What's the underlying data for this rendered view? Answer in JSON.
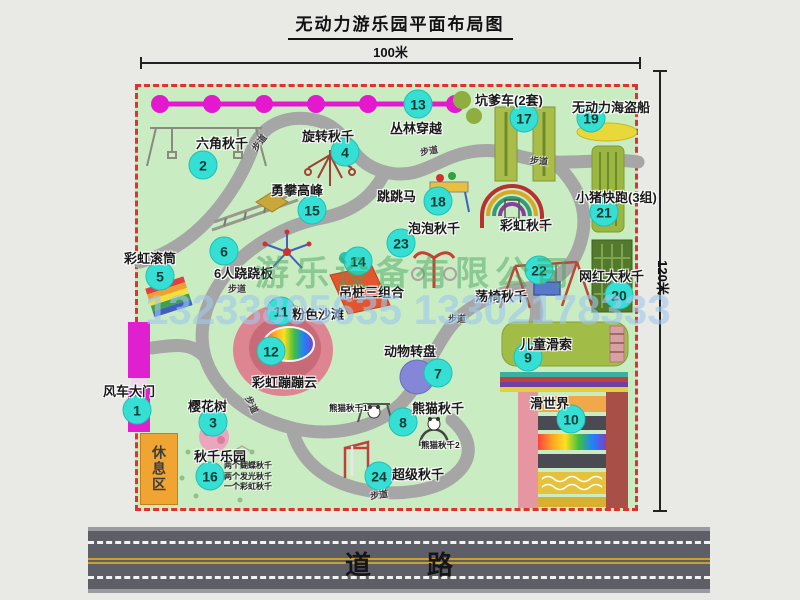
{
  "title": "无动力游乐园平面布局图",
  "dimensions": {
    "width_label": "100米",
    "height_label": "120米"
  },
  "road_label": "道路",
  "watermark": {
    "company": "游乐设备有限公司",
    "phones": "13233805635 13302178333"
  },
  "rest_area_label": "休息区",
  "walkway_label": "步道",
  "markers": [
    {
      "num": "1",
      "name": "风车大门",
      "cx": 137,
      "cy": 410,
      "lx": 103,
      "ly": 381
    },
    {
      "num": "2",
      "name": "六角秋千",
      "cx": 203,
      "cy": 165,
      "lx": 196,
      "ly": 133
    },
    {
      "num": "3",
      "name": "樱花树",
      "cx": 213,
      "cy": 422,
      "lx": 188,
      "ly": 396
    },
    {
      "num": "4",
      "name": "旋转秋千",
      "cx": 345,
      "cy": 152,
      "lx": 302,
      "ly": 126
    },
    {
      "num": "5",
      "name": "彩虹滚筒",
      "cx": 160,
      "cy": 276,
      "lx": 124,
      "ly": 248
    },
    {
      "num": "6",
      "name": "6人跷跷板",
      "cx": 224,
      "cy": 251,
      "lx": 214,
      "ly": 263
    },
    {
      "num": "7",
      "name": "动物转盘",
      "cx": 438,
      "cy": 373,
      "lx": 384,
      "ly": 341
    },
    {
      "num": "8",
      "name": "熊猫秋千",
      "cx": 403,
      "cy": 422,
      "lx": 412,
      "ly": 398
    },
    {
      "num": "9",
      "name": "儿童滑索",
      "cx": 528,
      "cy": 357,
      "lx": 520,
      "ly": 334
    },
    {
      "num": "10",
      "name": "滑世界",
      "cx": 571,
      "cy": 419,
      "lx": 530,
      "ly": 393
    },
    {
      "num": "11",
      "name": "粉色沙滩",
      "cx": 281,
      "cy": 311,
      "lx": 292,
      "ly": 304
    },
    {
      "num": "12",
      "name": "彩虹蹦蹦云",
      "cx": 271,
      "cy": 351,
      "lx": 252,
      "ly": 372
    },
    {
      "num": "13",
      "name": "丛林穿越",
      "cx": 418,
      "cy": 104,
      "lx": 390,
      "ly": 118
    },
    {
      "num": "14",
      "name": "吊桩三组合",
      "cx": 358,
      "cy": 261,
      "lx": 339,
      "ly": 282
    },
    {
      "num": "15",
      "name": "勇攀高峰",
      "cx": 312,
      "cy": 210,
      "lx": 271,
      "ly": 180
    },
    {
      "num": "16",
      "name": "秋千乐园",
      "cx": 210,
      "cy": 476,
      "lx": 194,
      "ly": 446,
      "details": [
        "两个蝴蝶秋千",
        "两个发光秋千",
        "一个彩虹秋千"
      ],
      "dlx": 224,
      "dly": 461
    },
    {
      "num": "17",
      "name": "坑爹车(2套)",
      "cx": 524,
      "cy": 118,
      "lx": 475,
      "ly": 90
    },
    {
      "num": "18",
      "name": "跳跳马",
      "cx": 438,
      "cy": 201,
      "lx": 377,
      "ly": 186
    },
    {
      "num": "19",
      "name": "无动力海盗船",
      "cx": 591,
      "cy": 118,
      "lx": 572,
      "ly": 97
    },
    {
      "num": "20",
      "name": "网红大秋千",
      "cx": 619,
      "cy": 295,
      "lx": 579,
      "ly": 266
    },
    {
      "num": "21",
      "name": "小猪快跑(3组)",
      "cx": 604,
      "cy": 212,
      "lx": 576,
      "ly": 187
    },
    {
      "num": "22",
      "name": "荡椅秋千",
      "cx": 539,
      "cy": 270,
      "lx": 475,
      "ly": 286
    },
    {
      "num": "23",
      "name": "泡泡秋千",
      "cx": 401,
      "cy": 243,
      "lx": 408,
      "ly": 218
    },
    {
      "num": "24",
      "name": "超级秋千",
      "cx": 379,
      "cy": 476,
      "lx": 392,
      "ly": 464
    }
  ],
  "extra_labels": [
    {
      "text": "彩虹秋千",
      "x": 500,
      "y": 215,
      "small": false
    },
    {
      "text": "熊猫秋千1",
      "x": 329,
      "y": 402,
      "small": true
    },
    {
      "text": "熊猫秋千2",
      "x": 421,
      "y": 439,
      "small": true
    }
  ],
  "walkways": [
    {
      "x": 250,
      "y": 136,
      "rot": -52
    },
    {
      "x": 420,
      "y": 144,
      "rot": -10
    },
    {
      "x": 530,
      "y": 154,
      "rot": 5
    },
    {
      "x": 228,
      "y": 282,
      "rot": 0
    },
    {
      "x": 448,
      "y": 312,
      "rot": 0
    },
    {
      "x": 243,
      "y": 398,
      "rot": 65
    },
    {
      "x": 370,
      "y": 488,
      "rot": -8
    }
  ]
}
